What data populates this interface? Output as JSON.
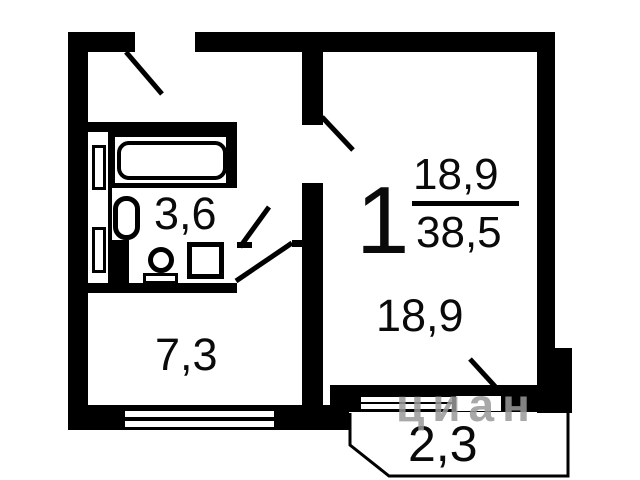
{
  "plan": {
    "title": "one-room apartment floor plan",
    "rooms": {
      "living": {
        "number": "1",
        "area": "18,9",
        "total": "38,5",
        "floor_label": "18,9"
      },
      "kitchen": {
        "area": "7,3"
      },
      "bathroom": {
        "area": "3,6"
      },
      "balcony": {
        "area": "2,3"
      }
    },
    "watermark": {
      "text": "циан"
    },
    "colors": {
      "wall": "#000000",
      "background": "#ffffff",
      "watermark": "#999999"
    }
  }
}
